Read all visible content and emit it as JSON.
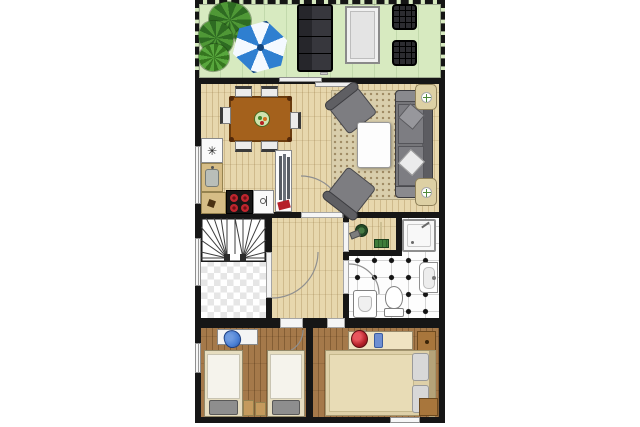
{
  "colors": {
    "wall": "#161616",
    "terrace_floor": "#d7eac0",
    "parquet": "#e7d7ad",
    "bedroom_floor": "#a5794a",
    "rug": "#d9ceac",
    "checker_dark": "#e6e6e6",
    "tile_grid": "#d4d4d4",
    "sofa_gray": "#76767a",
    "sofa_dark": "#5c5c61",
    "table_wood": "#a4611c",
    "counter_tan": "#d6bd86",
    "burner_red": "#c0262e",
    "umbrella_blue": "#2f7fd0",
    "plant_dark": "#2e6b22",
    "plant_mid": "#4f9836",
    "accent_red": "#b5202a",
    "accent_blue": "#4a7fd4",
    "door_arc": "#8f8f8f"
  },
  "kitchen": {
    "cabinet_symbol": "✳"
  },
  "rooms": [
    {
      "name": "terrace",
      "furniture": [
        "potted plants",
        "parasol",
        "lounge sofa",
        "side table",
        "stool",
        "stool"
      ]
    },
    {
      "name": "dining room",
      "furniture": [
        "dining table",
        "six chairs",
        "fruit bowl"
      ]
    },
    {
      "name": "living room",
      "furniture": [
        "sofa",
        "two armchairs",
        "coffee table",
        "rug",
        "two side tables"
      ]
    },
    {
      "name": "kitchen",
      "furniture": [
        "upper cabinet",
        "sink counter",
        "corner cabinet",
        "stove",
        "sink cabinet",
        "wardrobe"
      ]
    },
    {
      "name": "stairwell",
      "furniture": [
        "winder stairs",
        "checkered landing"
      ]
    },
    {
      "name": "hallway",
      "furniture": []
    },
    {
      "name": "utility niche",
      "furniture": [
        "bucket",
        "broom"
      ]
    },
    {
      "name": "bathroom",
      "furniture": [
        "shower",
        "washbasin",
        "toilet",
        "bidet"
      ]
    },
    {
      "name": "twin bedroom",
      "furniture": [
        "single bed",
        "single bed",
        "desk",
        "blue chair",
        "two nightstands"
      ]
    },
    {
      "name": "double bedroom",
      "furniture": [
        "double bed",
        "dresser",
        "two nightstands"
      ]
    }
  ]
}
